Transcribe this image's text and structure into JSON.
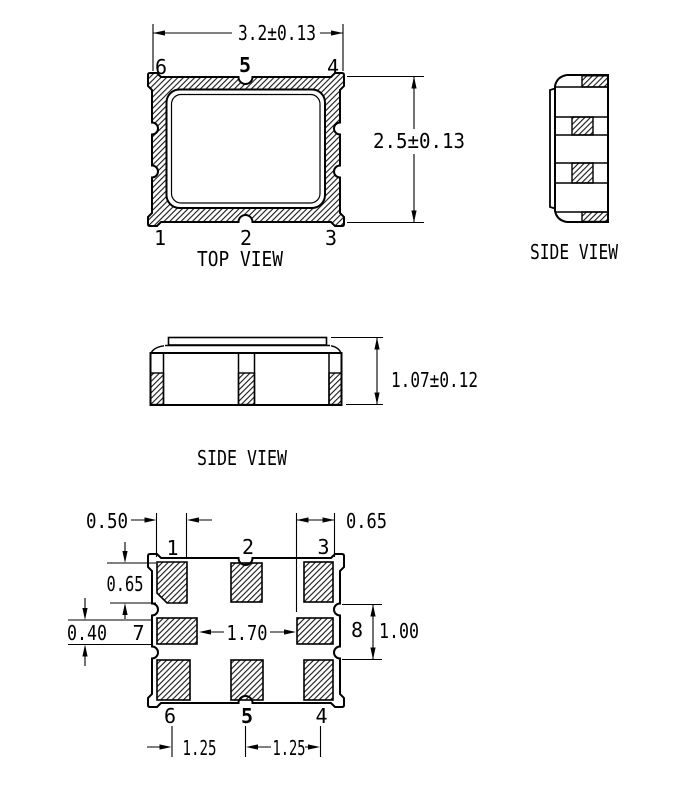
{
  "top_view": {
    "label": "TOP VIEW",
    "width_dim": "3.2±0.13",
    "height_dim": "2.5±0.13",
    "pins": {
      "top_left": "6",
      "top_center": "5",
      "top_right": "4",
      "bottom_left": "1",
      "bottom_center": "2",
      "bottom_right": "3"
    }
  },
  "side_view_right": {
    "label": "SIDE VIEW"
  },
  "front_view": {
    "label": "SIDE VIEW",
    "height_dim": "1.07±0.12"
  },
  "bottom_view": {
    "pins": {
      "p1": "1",
      "p2": "2",
      "p3": "3",
      "p7": "7",
      "p8": "8",
      "p6": "6",
      "p5": "5",
      "p4": "4"
    },
    "dims": {
      "pad_width": "0.50",
      "corner_pad": "0.65",
      "pad1_height": "0.65",
      "pad7_height": "0.40",
      "center_gap": "1.70",
      "mid_height": "1.00",
      "pitch_left": "1.25",
      "pitch_right": "1.25"
    }
  },
  "colors": {
    "line": "#000000",
    "background": "#ffffff"
  }
}
